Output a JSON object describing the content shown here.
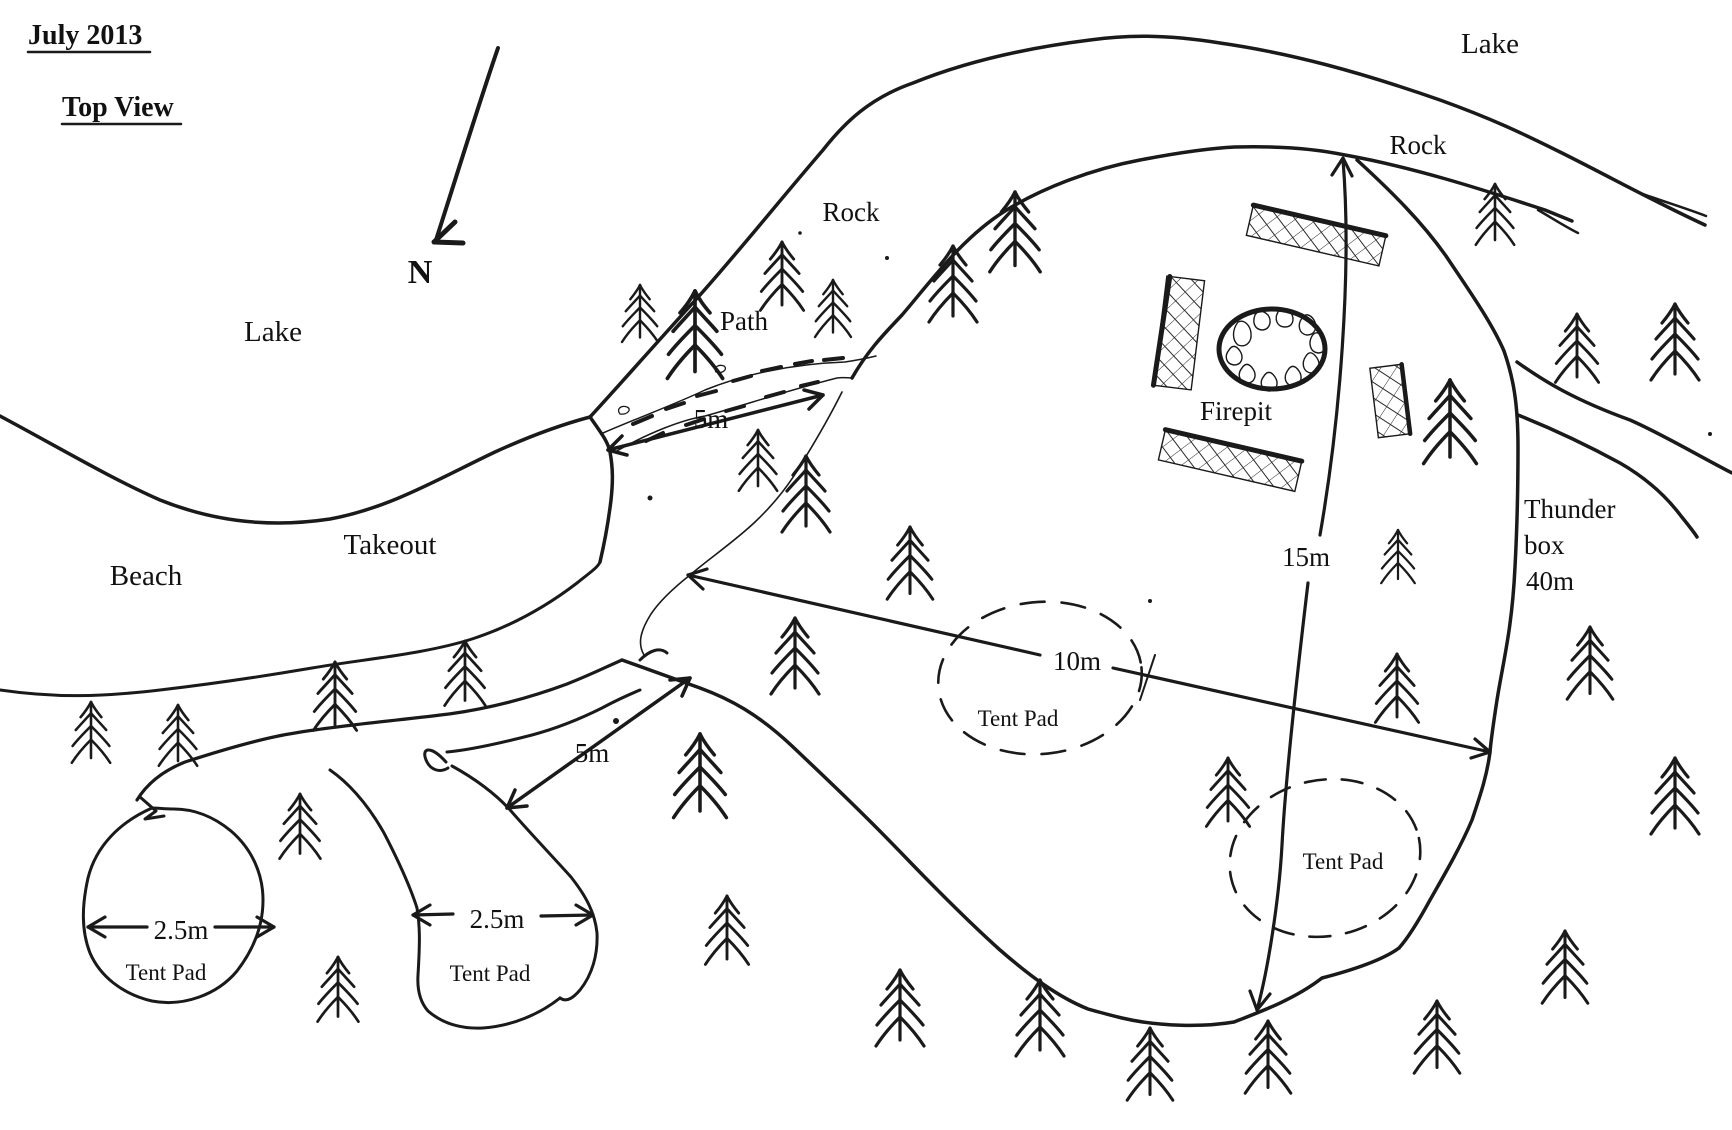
{
  "title": {
    "date": "July 2013",
    "view": "Top View"
  },
  "compass": {
    "north_label": "N"
  },
  "labels": {
    "lake_west": "Lake",
    "lake_north": "Lake",
    "rock_hill": "Rock",
    "rock_shore": "Rock",
    "path": "Path",
    "takeout": "Takeout",
    "beach": "Beach",
    "firepit": "Firepit",
    "thunder_box_line1": "Thunder",
    "thunder_box_line2": "box",
    "thunder_box_line3": "40m",
    "tent_pad_main": "Tent Pad",
    "tent_pad_east": "Tent Pad",
    "tent_pad_southwest": "Tent Pad",
    "tent_pad_south": "Tent Pad"
  },
  "measurements": {
    "path_width": "5m",
    "trail_width": "5m",
    "clearing_width": "10m",
    "clearing_length": "15m",
    "tent_pad_southwest_diameter": "2.5m",
    "tent_pad_south_diameter": "2.5m"
  },
  "colors": {
    "ink": "#1a1a1a",
    "paper": "#ffffff"
  }
}
